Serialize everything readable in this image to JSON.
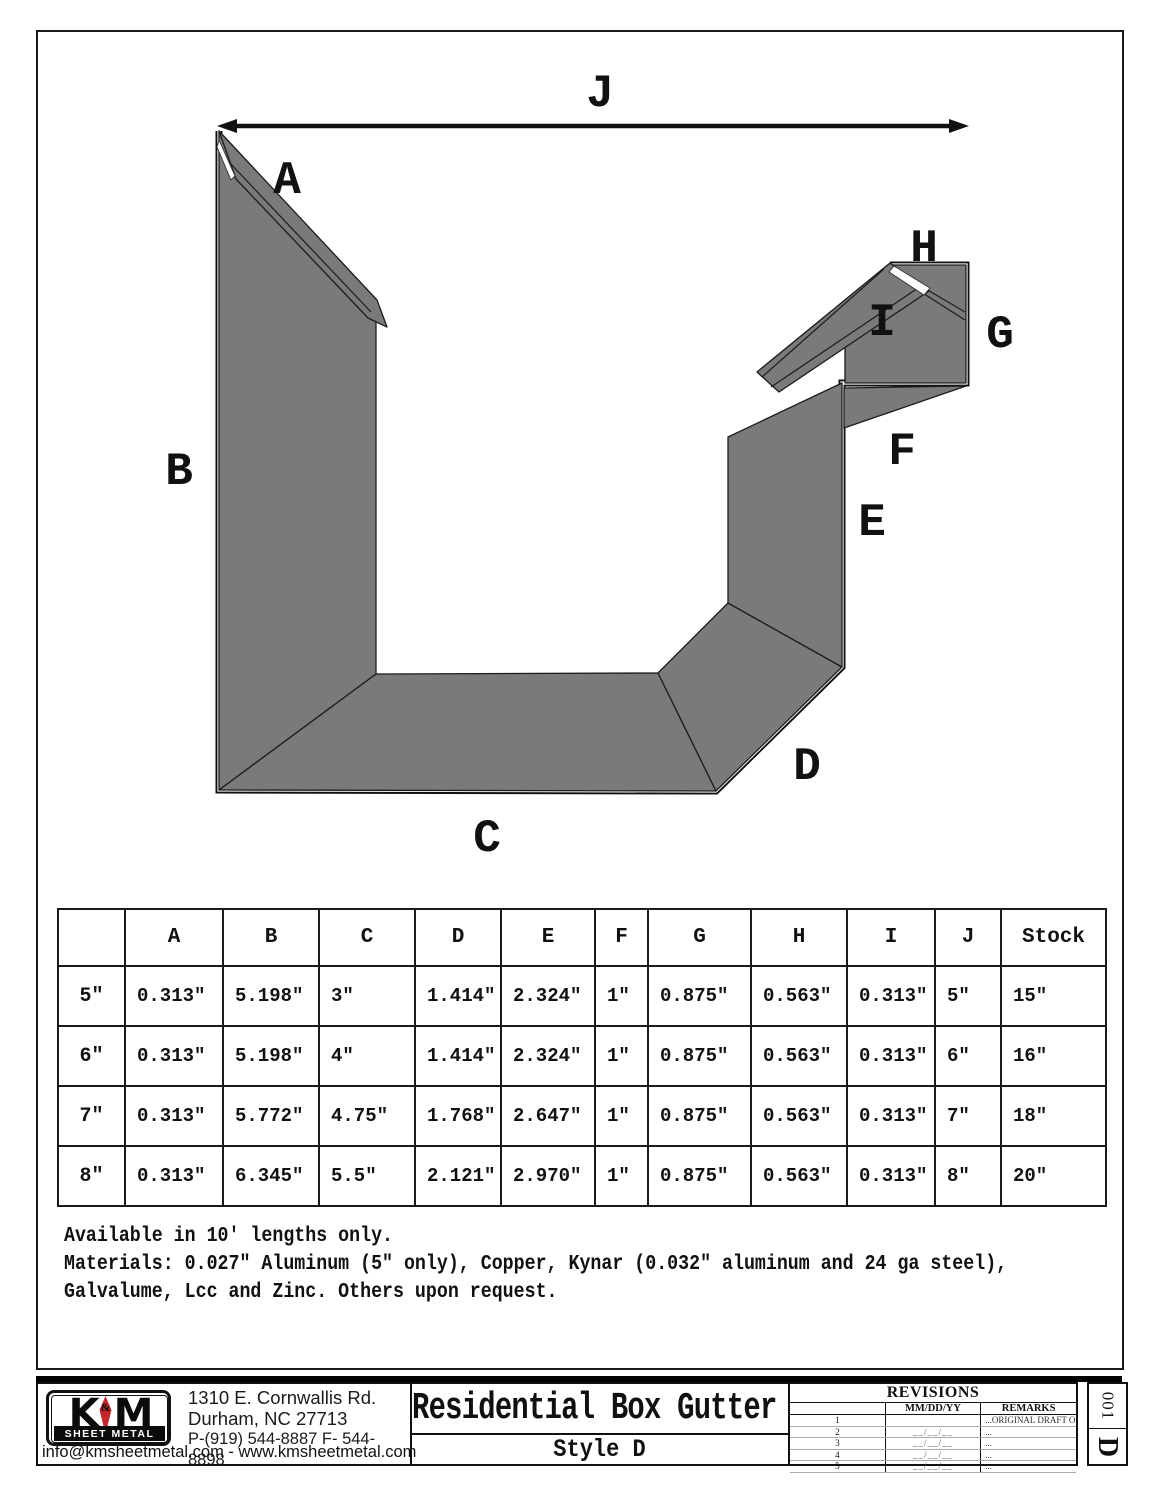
{
  "drawing": {
    "labels": {
      "A": "A",
      "B": "B",
      "C": "C",
      "D": "D",
      "E": "E",
      "F": "F",
      "G": "G",
      "H": "H",
      "I": "I",
      "J": "J"
    },
    "fill_color": "#7a7a7a",
    "line_color": "#1c1c1c"
  },
  "table": {
    "headers": [
      "",
      "A",
      "B",
      "C",
      "D",
      "E",
      "F",
      "G",
      "H",
      "I",
      "J",
      "Stock"
    ],
    "rows": [
      [
        "5\"",
        "0.313\"",
        "5.198\"",
        "3\"",
        "1.414\"",
        "2.324\"",
        "1\"",
        "0.875\"",
        "0.563\"",
        "0.313\"",
        "5\"",
        "15\""
      ],
      [
        "6\"",
        "0.313\"",
        "5.198\"",
        "4\"",
        "1.414\"",
        "2.324\"",
        "1\"",
        "0.875\"",
        "0.563\"",
        "0.313\"",
        "6\"",
        "16\""
      ],
      [
        "7\"",
        "0.313\"",
        "5.772\"",
        "4.75\"",
        "1.768\"",
        "2.647\"",
        "1\"",
        "0.875\"",
        "0.563\"",
        "0.313\"",
        "7\"",
        "18\""
      ],
      [
        "8\"",
        "0.313\"",
        "6.345\"",
        "5.5\"",
        "2.121\"",
        "2.970\"",
        "1\"",
        "0.875\"",
        "0.563\"",
        "0.313\"",
        "8\"",
        "20\""
      ]
    ]
  },
  "notes": {
    "lines": [
      "Available in 10' lengths only.",
      "Materials: 0.027\" Aluminum (5\" only), Copper, Kynar (0.032\" aluminum and 24 ga steel),",
      "Galvalume, Lcc and Zinc. Others upon request."
    ]
  },
  "footer": {
    "logo": {
      "k": "K",
      "m": "M",
      "amp": "&",
      "subtitle": "SHEET METAL"
    },
    "company": {
      "address1": "1310 E. Cornwallis Rd.",
      "address2": "Durham, NC 27713",
      "phone": "P-(919) 544-8887 F- 544-8898",
      "email_web": "info@kmsheetmetal.com - www.kmsheetmetal.com"
    },
    "title": "Residential Box Gutter",
    "subtitle": "Style D",
    "revisions": {
      "title": "REVISIONS",
      "col_date": "MM/DD/YY",
      "col_remarks": "REMARKS",
      "rows": [
        {
          "n": "1",
          "date": "",
          "remarks": "...ORIGINAL DRAFT OF DRAWING"
        },
        {
          "n": "2",
          "date": "__/__/__",
          "remarks": "..."
        },
        {
          "n": "3",
          "date": "__/__/__",
          "remarks": "..."
        },
        {
          "n": "4",
          "date": "__/__/__",
          "remarks": "..."
        },
        {
          "n": "5",
          "date": "__/__/__",
          "remarks": "..."
        }
      ]
    },
    "sheet": {
      "number": "001",
      "letter": "D"
    }
  }
}
